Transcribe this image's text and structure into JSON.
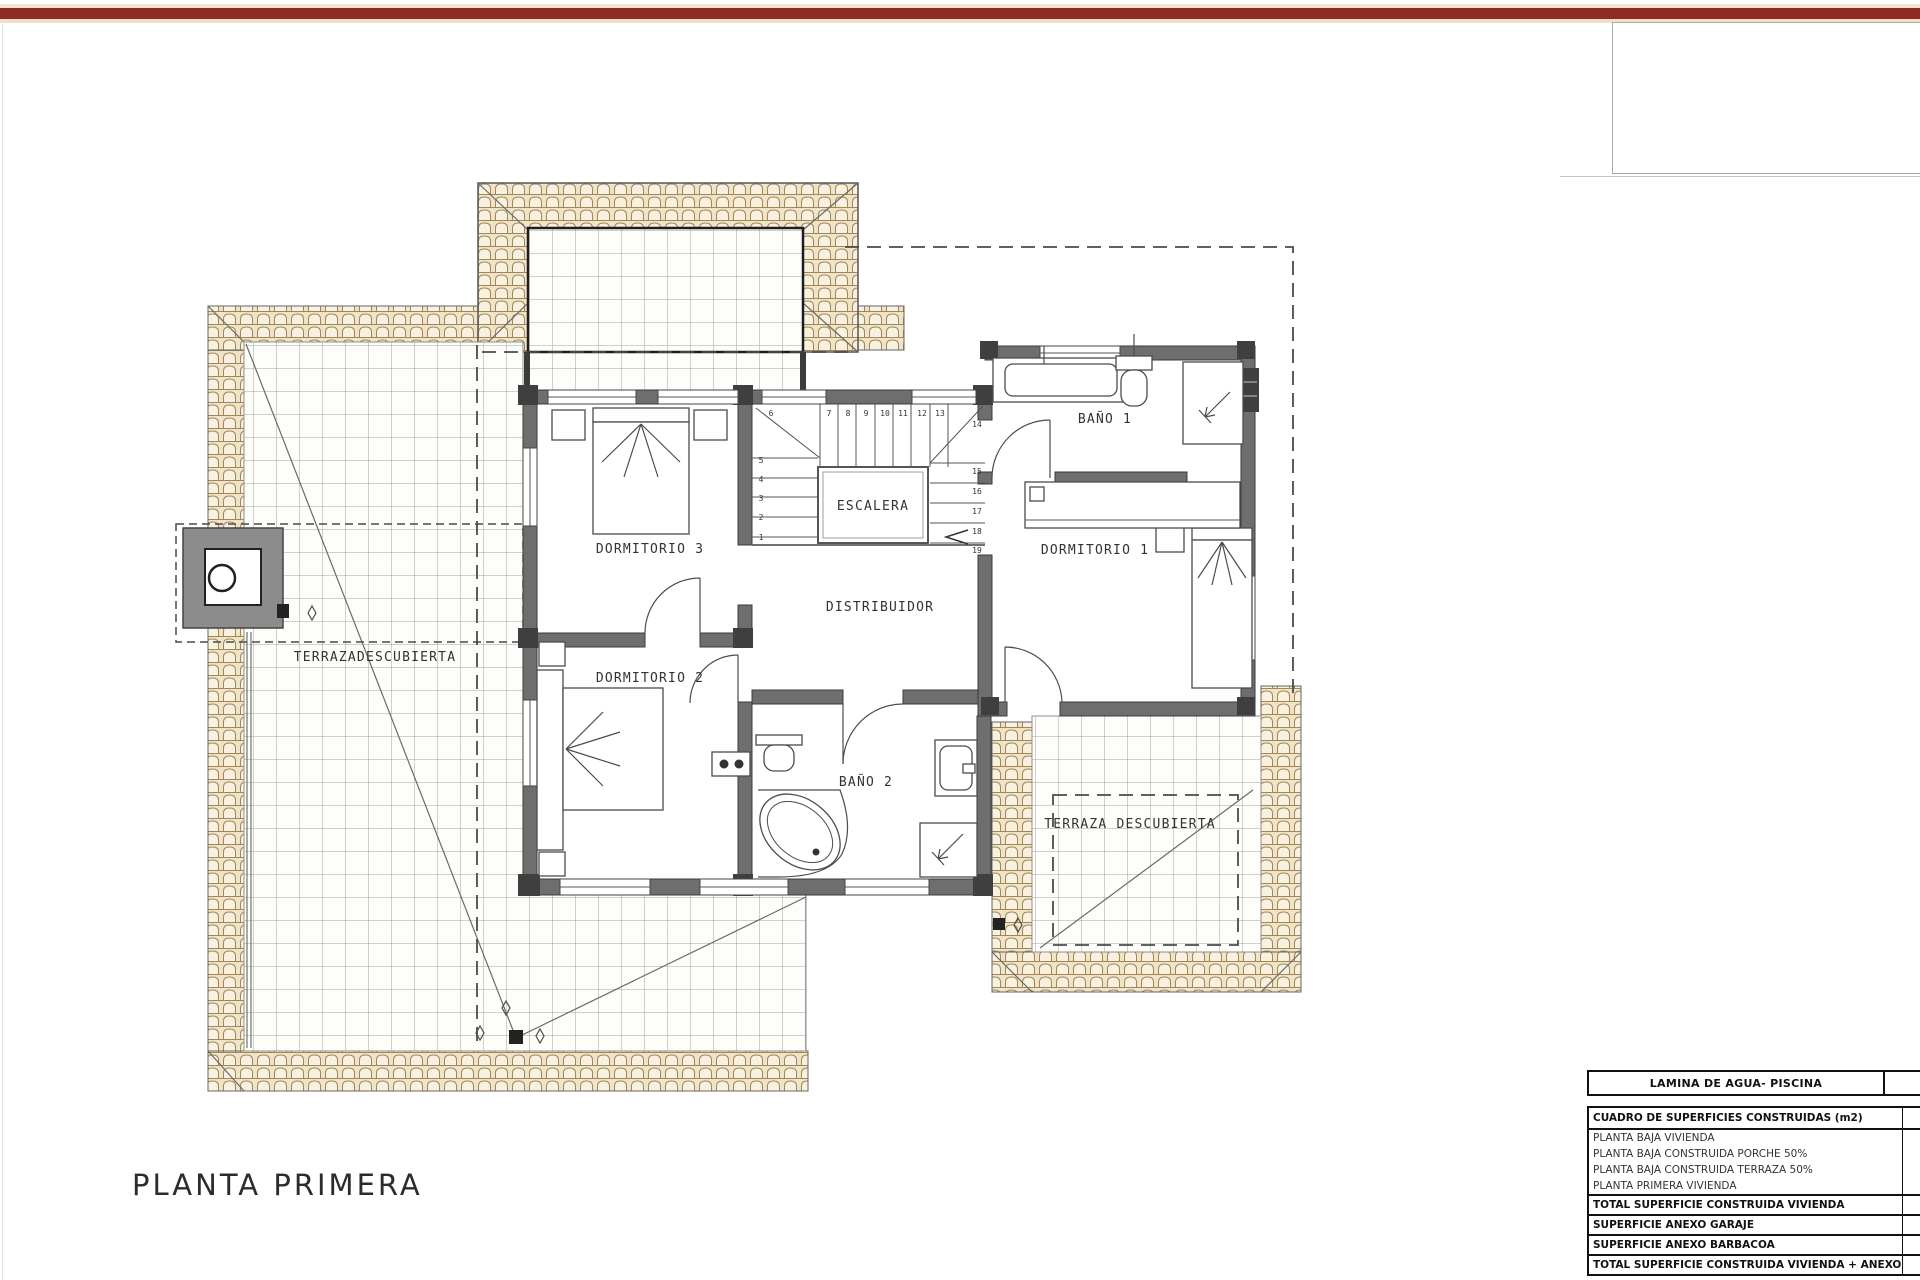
{
  "top_bar": {
    "color": "#8e2b22",
    "halo_color": "#f3e6d0"
  },
  "title_block": {
    "title": "PLANTA PRIMERA"
  },
  "plan": {
    "rooms": {
      "dormitorio3": "DORMITORIO 3",
      "dormitorio2": "DORMITORIO 2",
      "dormitorio1": "DORMITORIO 1",
      "bano1": "BAÑO 1",
      "bano2": "BAÑO 2",
      "escalera": "ESCALERA",
      "distribuidor": "DISTRIBUIDOR",
      "terraza_izquierda": "TERRAZADESCUBIERTA",
      "terraza_derecha": "TERRAZA DESCUBIERTA"
    },
    "stair_numbers": [
      "1",
      "2",
      "3",
      "4",
      "5",
      "6",
      "7",
      "8",
      "9",
      "10",
      "11",
      "12",
      "13",
      "14",
      "15",
      "16",
      "17",
      "18",
      "19"
    ]
  },
  "summary_tables": {
    "piscina": {
      "label": "LAMINA DE AGUA- PISCINA",
      "value": ""
    },
    "superficies": {
      "header": "CUADRO DE SUPERFICIES CONSTRUIDAS (m2)",
      "header_value": "",
      "rows": [
        {
          "label": "PLANTA BAJA VIVIENDA",
          "value": ""
        },
        {
          "label": "PLANTA BAJA CONSTRUIDA PORCHE 50%",
          "value": ""
        },
        {
          "label": "PLANTA BAJA CONSTRUIDA TERRAZA 50%",
          "value": ""
        },
        {
          "label": "PLANTA PRIMERA VIVIENDA",
          "value": ""
        },
        {
          "label": "TOTAL SUPERFICIE CONSTRUIDA VIVIENDA",
          "value": ""
        },
        {
          "label": "SUPERFICIE ANEXO GARAJE",
          "value": ""
        },
        {
          "label": "SUPERFICIE ANEXO BARBACOA",
          "value": ""
        },
        {
          "label": "TOTAL SUPERFICIE CONSTRUIDA VIVIENDA + ANEXOS",
          "value": ""
        }
      ]
    }
  },
  "colors": {
    "banner": "#8e2b22",
    "wall": "#6e6e6e",
    "tile_fill": "#efe3c8",
    "tile_line": "#a18757",
    "grid_line": "#a3a49e"
  }
}
